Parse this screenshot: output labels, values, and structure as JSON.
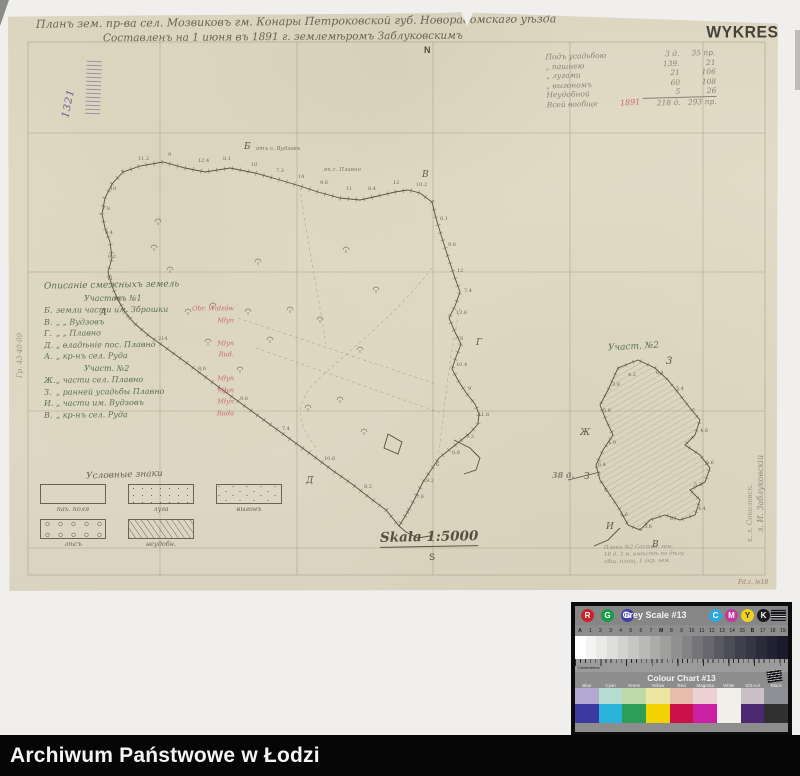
{
  "header": {
    "title_line1": "Планъ зем. пр-ва сел. Мозвиковъ гм. Конары Петроковской губ. Новорадомскаго уѣзда",
    "title_line2": "Составленъ на 1 июня въ 1891 г. землемѣромъ Заблуковскимъ",
    "wykres_stamp": "WYKRES",
    "archive_number": "1321"
  },
  "compass": {
    "north": "N",
    "south": "S"
  },
  "scale_label": "Skala 1:5000",
  "area_table": {
    "rows": [
      {
        "label": "Подъ усадьбою",
        "v1": "3 д.",
        "v2": "35 пр."
      },
      {
        "label": "„  пашнею",
        "v1": "139.",
        "v2": "21"
      },
      {
        "label": "„  лугами",
        "v1": "21",
        "v2": "106"
      },
      {
        "label": "„  выгономъ",
        "v1": "60",
        "v2": "108"
      },
      {
        "label": "Неудобной",
        "v1": "5",
        "v2": "26"
      },
      {
        "label": "Всей вообще",
        "v1": "218 д.",
        "v2": "293 пр."
      }
    ],
    "red_note": "1891"
  },
  "adjacent_lands": {
    "heading": "Описаніе смежныхъ земель",
    "section1": "Участокъ №1",
    "rows1": [
      {
        "letter": "Б.",
        "text": "земли части им. Зброшки",
        "red": "Obr. Widzów"
      },
      {
        "letter": "В.",
        "text": "„    „    Вудзовъ",
        "red": "Młyn"
      },
      {
        "letter": "Г.",
        "text": "„    „    Плавно",
        "red": ""
      },
      {
        "letter": "Д.",
        "text": "„  владѣніе пос. Плавно",
        "red": "Młyn"
      },
      {
        "letter": "А.",
        "text": "„  кр-нъ сел. Руда",
        "red": "Rud."
      }
    ],
    "section2": "Участ. №2",
    "rows2": [
      {
        "letter": "Ж.",
        "text": "„  части сел. Плавно",
        "red": "Młyn"
      },
      {
        "letter": "З.",
        "text": "„  ранней усадьбы Плавно",
        "red": "Młyn"
      },
      {
        "letter": "И.",
        "text": "„  части им. Вудзовъ",
        "red": "Młyn"
      },
      {
        "letter": "В.",
        "text": "„  кр-нъ сел. Руда",
        "red": "Ruda"
      }
    ]
  },
  "legend": {
    "title": "Условные знаки",
    "items": [
      {
        "label": "пах. поля",
        "fill": "plain"
      },
      {
        "label": "луга",
        "fill": "dots"
      },
      {
        "label": "выгонъ",
        "fill": "marks"
      },
      {
        "label": "лѣсъ",
        "fill": "trees"
      },
      {
        "label": "неудобн.",
        "fill": "hatch"
      }
    ]
  },
  "parcel2": {
    "label": "Участ. №2",
    "corner_number": "3",
    "area_note": "38 д."
  },
  "boundary_labels": [
    {
      "x": 248,
      "y": 134,
      "t": "отъ с. Вудзовъ"
    },
    {
      "x": 316,
      "y": 155,
      "t": "въ с. Плавно"
    }
  ],
  "pencil_note_lines": [
    "Планъ №2 Состав. зем.",
    "18 д. 3 м. вмѣстѣ по дѣлу",
    "общ. площ. 1 окр. зем."
  ],
  "left_rotated_note": "Гр. 43-40-09",
  "signature": "з. И. Заблуковскій",
  "signature2": "к. з. Соколовск.",
  "archive_note": "Fd.z. №18",
  "caption_bar": {
    "text": "Archiwum Państwowe w Łodzi"
  },
  "map_letters": [
    {
      "x": 236,
      "y": 130,
      "t": "Б"
    },
    {
      "x": 414,
      "y": 158,
      "t": "В"
    },
    {
      "x": 468,
      "y": 326,
      "t": "Г"
    },
    {
      "x": 298,
      "y": 464,
      "t": "Д"
    },
    {
      "x": 92,
      "y": 296,
      "t": "А"
    },
    {
      "x": 572,
      "y": 416,
      "t": "Ж"
    },
    {
      "x": 576,
      "y": 460,
      "t": "З"
    },
    {
      "x": 598,
      "y": 510,
      "t": "И"
    },
    {
      "x": 644,
      "y": 528,
      "t": "В"
    }
  ],
  "map_numbers": [
    {
      "x": 130,
      "y": 144,
      "t": "11.2"
    },
    {
      "x": 160,
      "y": 140,
      "t": "9"
    },
    {
      "x": 190,
      "y": 146,
      "t": "12.4"
    },
    {
      "x": 215,
      "y": 144,
      "t": "8.1"
    },
    {
      "x": 243,
      "y": 150,
      "t": "10"
    },
    {
      "x": 268,
      "y": 156,
      "t": "7.3"
    },
    {
      "x": 290,
      "y": 162,
      "t": "14"
    },
    {
      "x": 312,
      "y": 168,
      "t": "9.6"
    },
    {
      "x": 338,
      "y": 174,
      "t": "11"
    },
    {
      "x": 360,
      "y": 174,
      "t": "8.4"
    },
    {
      "x": 385,
      "y": 168,
      "t": "12"
    },
    {
      "x": 408,
      "y": 170,
      "t": "10.2"
    },
    {
      "x": 432,
      "y": 204,
      "t": "6.1"
    },
    {
      "x": 440,
      "y": 230,
      "t": "9.8"
    },
    {
      "x": 449,
      "y": 256,
      "t": "12"
    },
    {
      "x": 456,
      "y": 276,
      "t": "7.4"
    },
    {
      "x": 448,
      "y": 298,
      "t": "13.6"
    },
    {
      "x": 452,
      "y": 324,
      "t": "8"
    },
    {
      "x": 448,
      "y": 350,
      "t": "10.4"
    },
    {
      "x": 460,
      "y": 374,
      "t": "9"
    },
    {
      "x": 470,
      "y": 400,
      "t": "11.8"
    },
    {
      "x": 458,
      "y": 422,
      "t": "7.2"
    },
    {
      "x": 444,
      "y": 438,
      "t": "8.8"
    },
    {
      "x": 428,
      "y": 450,
      "t": "6"
    },
    {
      "x": 418,
      "y": 466,
      "t": "9.2"
    },
    {
      "x": 408,
      "y": 482,
      "t": "7.6"
    },
    {
      "x": 398,
      "y": 498,
      "t": "8"
    },
    {
      "x": 102,
      "y": 174,
      "t": "10"
    },
    {
      "x": 94,
      "y": 194,
      "t": "7.8"
    },
    {
      "x": 97,
      "y": 218,
      "t": "9.4"
    },
    {
      "x": 100,
      "y": 242,
      "t": "8.2"
    },
    {
      "x": 99,
      "y": 264,
      "t": "11"
    },
    {
      "x": 106,
      "y": 284,
      "t": "6.8"
    },
    {
      "x": 118,
      "y": 302,
      "t": "9"
    },
    {
      "x": 150,
      "y": 324,
      "t": "214"
    },
    {
      "x": 190,
      "y": 354,
      "t": "8.6"
    },
    {
      "x": 232,
      "y": 384,
      "t": "9.8"
    },
    {
      "x": 274,
      "y": 414,
      "t": "7.4"
    },
    {
      "x": 316,
      "y": 444,
      "t": "10.6"
    },
    {
      "x": 356,
      "y": 472,
      "t": "8.2"
    },
    {
      "x": 620,
      "y": 360,
      "t": "4.2"
    },
    {
      "x": 648,
      "y": 358,
      "t": "6.1"
    },
    {
      "x": 668,
      "y": 374,
      "t": "5.4"
    },
    {
      "x": 684,
      "y": 396,
      "t": "7"
    },
    {
      "x": 692,
      "y": 416,
      "t": "4.8"
    },
    {
      "x": 698,
      "y": 448,
      "t": "6.6"
    },
    {
      "x": 686,
      "y": 470,
      "t": "5.2"
    },
    {
      "x": 690,
      "y": 494,
      "t": "4.4"
    },
    {
      "x": 662,
      "y": 504,
      "t": "6"
    },
    {
      "x": 636,
      "y": 512,
      "t": "5.8"
    },
    {
      "x": 612,
      "y": 500,
      "t": "4.6"
    },
    {
      "x": 596,
      "y": 476,
      "t": "5"
    },
    {
      "x": 590,
      "y": 450,
      "t": "6.4"
    },
    {
      "x": 600,
      "y": 428,
      "t": "4.9"
    },
    {
      "x": 595,
      "y": 396,
      "t": "5.6"
    },
    {
      "x": 604,
      "y": 370,
      "t": "3.8"
    }
  ],
  "trees": [
    {
      "x": 150,
      "y": 210
    },
    {
      "x": 250,
      "y": 250
    },
    {
      "x": 205,
      "y": 294
    },
    {
      "x": 338,
      "y": 238
    },
    {
      "x": 262,
      "y": 328
    },
    {
      "x": 232,
      "y": 358
    },
    {
      "x": 312,
      "y": 308
    },
    {
      "x": 162,
      "y": 258
    },
    {
      "x": 368,
      "y": 278
    },
    {
      "x": 332,
      "y": 388
    },
    {
      "x": 282,
      "y": 298
    },
    {
      "x": 352,
      "y": 338
    },
    {
      "x": 300,
      "y": 396
    },
    {
      "x": 200,
      "y": 330
    },
    {
      "x": 240,
      "y": 300
    },
    {
      "x": 356,
      "y": 420
    },
    {
      "x": 146,
      "y": 236
    },
    {
      "x": 180,
      "y": 300
    }
  ],
  "color_target": {
    "grey_scale_title": "Grey Scale #13",
    "colour_chart_title": "Colour Chart #13",
    "ruler_word": "Centimetres",
    "rgb_circles": [
      {
        "t": "R",
        "c": "#cc2229"
      },
      {
        "t": "G",
        "c": "#199a49"
      },
      {
        "t": "B",
        "c": "#4340a8"
      }
    ],
    "cmyk_circles": [
      {
        "t": "C",
        "c": "#2aa9e0"
      },
      {
        "t": "M",
        "c": "#bf3a9c"
      },
      {
        "t": "Y",
        "c": "#f0d020"
      },
      {
        "t": "K",
        "c": "#1a1a1a"
      }
    ],
    "scale_ticks": [
      "A",
      "1",
      "2",
      "3",
      "4",
      "5",
      "6",
      "7",
      "M",
      "8",
      "9",
      "10",
      "11",
      "12",
      "13",
      "14",
      "15",
      "B",
      "17",
      "18",
      "19"
    ],
    "grey_steps": [
      "#ffffff",
      "#f4f4f2",
      "#e9e9e7",
      "#dededc",
      "#d2d2d0",
      "#c6c6c4",
      "#b9b9b7",
      "#acacaa",
      "#9f9f9d",
      "#919191",
      "#838385",
      "#757579",
      "#67676d",
      "#595961",
      "#4c4c56",
      "#40404c",
      "#353543",
      "#2b2b3a",
      "#222232",
      "#1a1a2b"
    ],
    "patch_labels": [
      "Blue",
      "Cyan",
      "Green",
      "Yellow",
      "Red",
      "Magenta",
      "White",
      "S/S-col",
      "Black"
    ],
    "patches_light": [
      "#b4a9d2",
      "#b5dcd0",
      "#bedaa8",
      "#ece6a2",
      "#e6bcab",
      "#ecd0d2",
      "#f2efe8",
      "#cabfc6",
      "#8f8f97"
    ],
    "patches_dark": [
      "#3c3aa0",
      "#2ab4dc",
      "#2d9e58",
      "#f2d200",
      "#cc1048",
      "#ca20a4",
      "#f2efe8",
      "#4c2a72",
      "#303030"
    ]
  }
}
